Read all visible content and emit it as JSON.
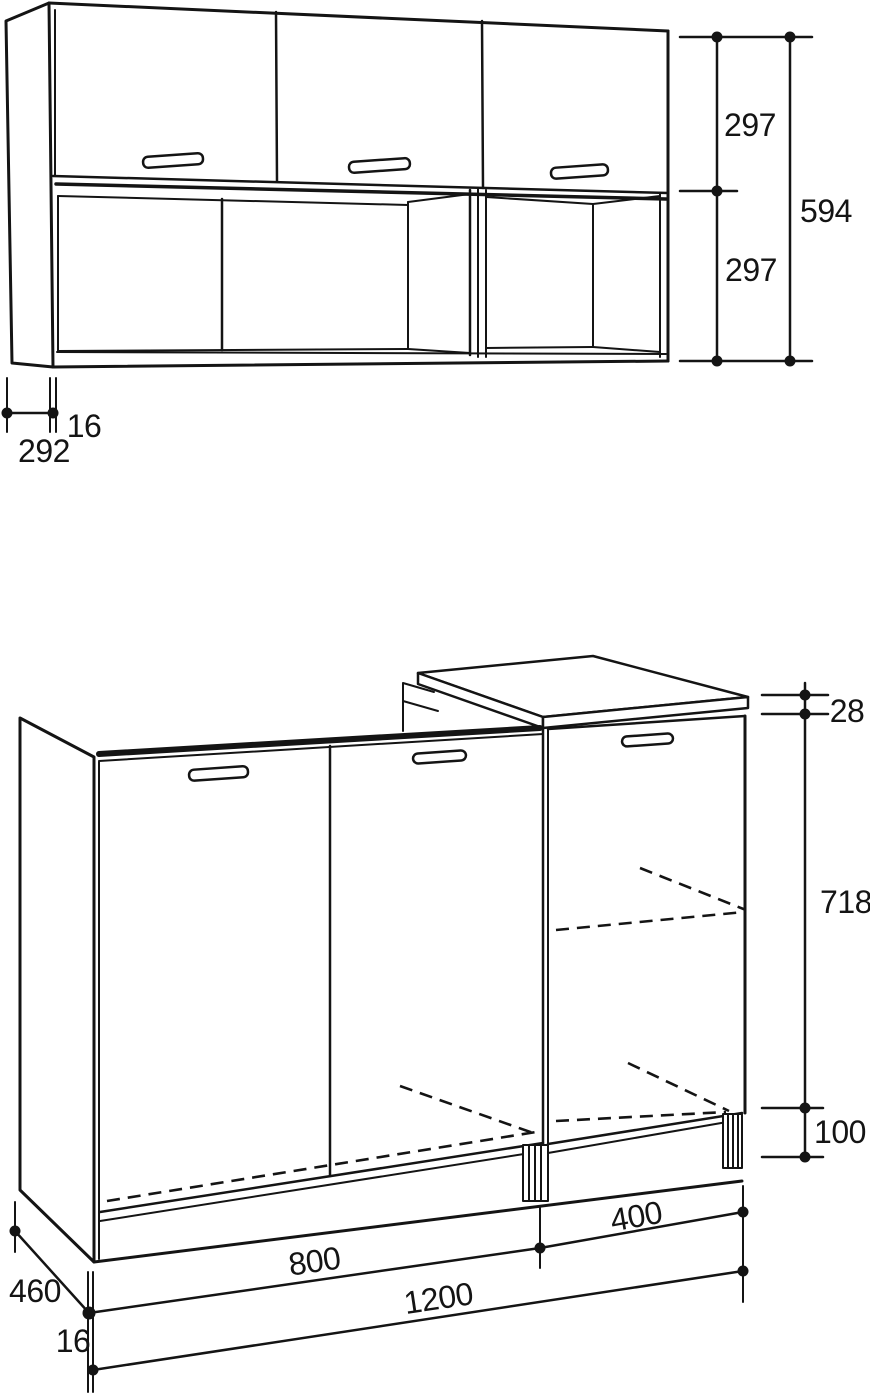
{
  "diagram": {
    "kind": "furniture technical drawing",
    "views": [
      "wall-cabinet",
      "base-cabinet"
    ],
    "line_color": "#141414",
    "background": "#ffffff"
  },
  "wall_cabinet": {
    "upper_height": "297",
    "lower_height": "297",
    "total_height": "594",
    "depth": "292",
    "panel_thickness": "16"
  },
  "base_cabinet": {
    "top_thickness": "28",
    "carcass_height": "718",
    "plinth_height": "100",
    "right_unit_width": "400",
    "left_unit_width": "800",
    "total_width": "1200",
    "depth": "460",
    "panel_thickness": "16"
  }
}
